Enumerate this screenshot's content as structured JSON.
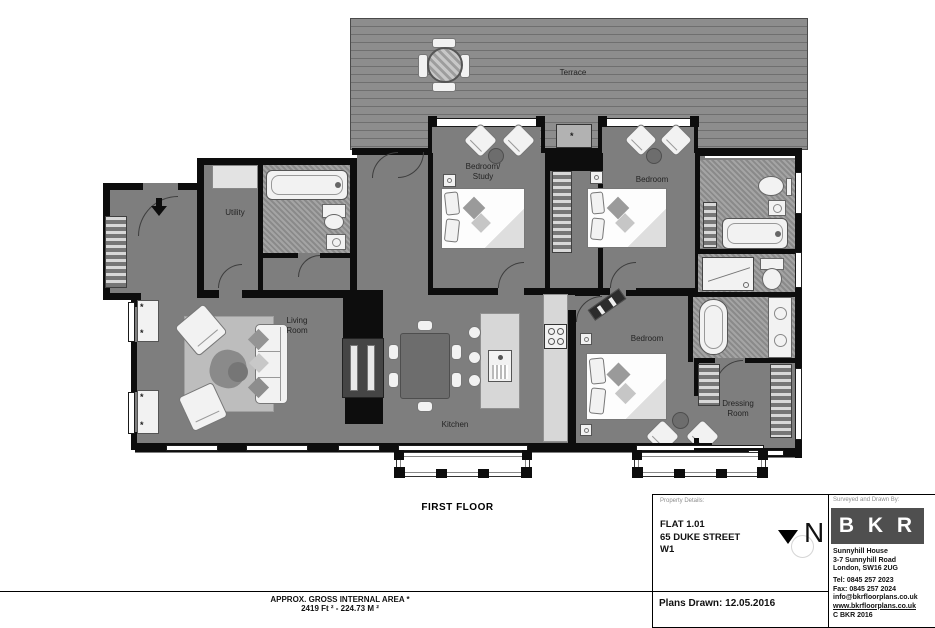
{
  "floor_plan": {
    "title": "FIRST FLOOR",
    "rooms": {
      "terrace": "Terrace",
      "bedroom_study_line1": "Bedroom/",
      "bedroom_study_line2": "Study",
      "bedroom_top": "Bedroom",
      "utility": "Utility",
      "living_line1": "Living",
      "living_line2": "Room",
      "kitchen": "Kitchen",
      "bedroom_bottom": "Bedroom",
      "dressing_line1": "Dressing",
      "dressing_line2": "Room"
    }
  },
  "area_summary": {
    "line1": "APPROX. GROSS INTERNAL  AREA *",
    "line2": "2419 Ft ² - 224.73 M ²"
  },
  "property_panel": {
    "heading": "Property Details:",
    "flat": "FLAT 1.01",
    "street": "65 DUKE STREET",
    "postcode": "W1",
    "plans_drawn": "Plans Drawn: 12.05.2016",
    "north_letter": "N"
  },
  "surveyor_panel": {
    "heading": "Surveyed and Drawn By:",
    "logo_text": "B K R",
    "address_line1": "Sunnyhill House",
    "address_line2": "3-7 Sunnyhill Road",
    "address_line3": "London, SW16 2UG",
    "tel": "Tel:  0845 257 2023",
    "fax": "Fax: 0845 257 2024",
    "email": "info@bkrfloorplans.co.uk",
    "website": "www.bkrfloorplans.co.uk",
    "copyright": "C  BKR 2016"
  },
  "colors": {
    "wall": "#0d0d0d",
    "floor": "#7e7e7e",
    "terrace": "#8d8d8d",
    "plank": "#6f6f6f",
    "tile": "#9a9a9a",
    "logo_bg": "#4f4f4f"
  }
}
